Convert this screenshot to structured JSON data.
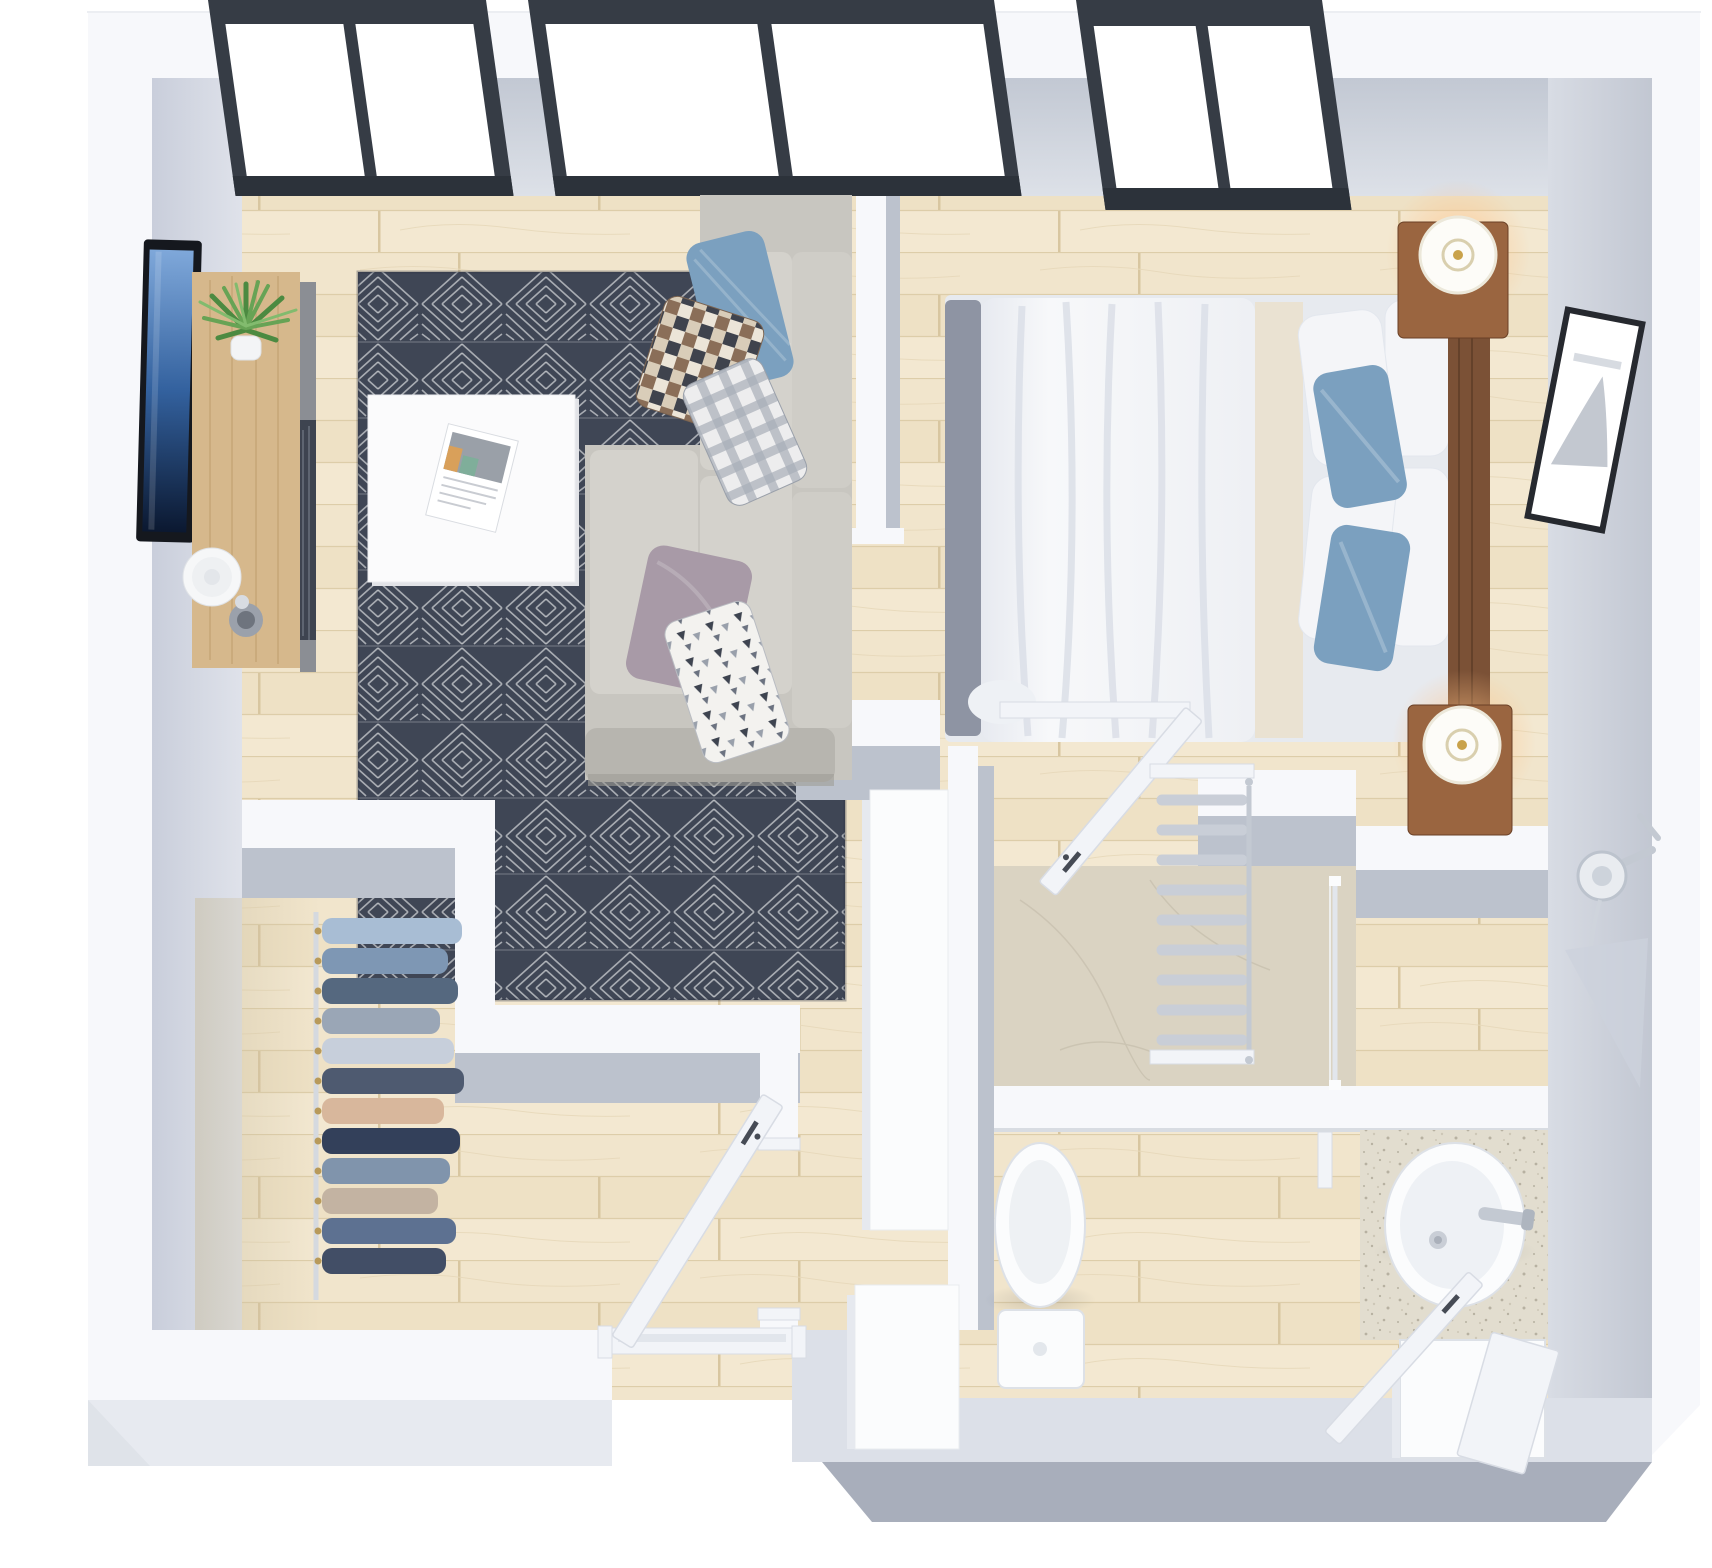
{
  "scene": {
    "description": "3D isometric floor plan rendering of a one-bedroom apartment viewed from above",
    "render_style": "photorealistic top-down 3D render, white walls, light wood floors",
    "rooms": [
      {
        "name": "living-room",
        "furniture": [
          "wall-mounted-tv",
          "media-console",
          "potted-plant",
          "decorative-plate",
          "vase",
          "geometric-area-rug",
          "white-coffee-table",
          "magazine",
          "corner-sofa",
          "throw-pillows"
        ]
      },
      {
        "name": "bedroom",
        "furniture": [
          "double-bed",
          "white-duvet",
          "white-pillows",
          "blue-accent-pillows",
          "wood-headboard",
          "nightstand-top",
          "table-lamp-lit",
          "nightstand-bottom",
          "table-lamp-lit",
          "framed-wall-art"
        ]
      },
      {
        "name": "walk-in-closet",
        "furniture": [
          "clothes-rail",
          "hanging-clothes"
        ]
      },
      {
        "name": "hallway",
        "furniture": [
          "tall-wardrobe",
          "shoe-cabinet"
        ]
      },
      {
        "name": "bathroom",
        "furniture": [
          "toilet",
          "oval-sink",
          "chrome-faucet",
          "vanity-cabinet",
          "towel-radiator",
          "marble-shower-area",
          "glass-divider",
          "wall-shower-head",
          "leaning-mirror"
        ]
      }
    ],
    "doors": [
      "entry-door-open",
      "bathroom-door-open",
      "closet-opening",
      "vanity-door-open"
    ],
    "windows": [
      "living-room-window-left-2-pane",
      "living-room-window-right-2-pane",
      "bedroom-window-2-pane"
    ],
    "closet": {
      "clothes_colors": [
        "#a8bdd4",
        "#7e97b4",
        "#55687f",
        "#9aa6b6",
        "#c7cfdb",
        "#4e5a70",
        "#d8b79c",
        "#33405a",
        "#8094ac",
        "#c3b3a2",
        "#5d7191",
        "#424e66"
      ]
    }
  },
  "colors": {
    "bg": "#ffffff",
    "wall": "#f7f8fb",
    "wallEdge": "#e4e7ed",
    "outerFaceLight": "#e7eaf0",
    "outerFaceMid": "#dce0e8",
    "outerFaceDark": "#a8aebb",
    "faceInner": "#bcc2cd",
    "windowFrame": "#363c45",
    "windowFrameDark": "#2c323a",
    "glass": "#ffffff",
    "wood": "#f1e5cc",
    "marble": "#dad3c2",
    "counter": "#e2ddcf",
    "rug": "#3f4655",
    "sofa": "#c8c6c0",
    "sofaCushion": "#d4d2cc",
    "sofaBase": "#b7b5af",
    "pillowBlue": "#7ba0bf",
    "pillowPurple": "#a89aa7",
    "tableWhite": "#fbfbfc",
    "tableEdge": "#e2e3e7",
    "consoleWood": "#d6b88c",
    "consoleFace": "#8b8e94",
    "consoleDrawer": "#3e4450",
    "tvFrame": "#15181e",
    "plant": "#67a355",
    "plantDark": "#4c8a41",
    "plate": "#f6f7f8",
    "vaseGray": "#9ba1ab",
    "bedWhite": "#f4f5f8",
    "bedShade": "#dfe3ea",
    "blanket": "#eae2d2",
    "footboard": "#8e94a3",
    "furnWood": "#7b5136",
    "furnWoodLit": "#9a6540",
    "lampShade": "#fdfcf8",
    "lampGold": "#c9a24a",
    "artFrame": "#26292f",
    "fixture": "#fbfcfd",
    "fixtureShade": "#dde1e7",
    "chrome": "#c3c9d2",
    "radiator": "#c9ced7",
    "doorWhite": "#f2f4f8",
    "doorEdge": "#d8dce4",
    "handleDark": "#464b55",
    "clothesRod": "#d5d9df",
    "hangerGold": "#b89a5a",
    "wardrobe": "#fbfcfd",
    "wardrobeSide": "#e6e9ef"
  }
}
